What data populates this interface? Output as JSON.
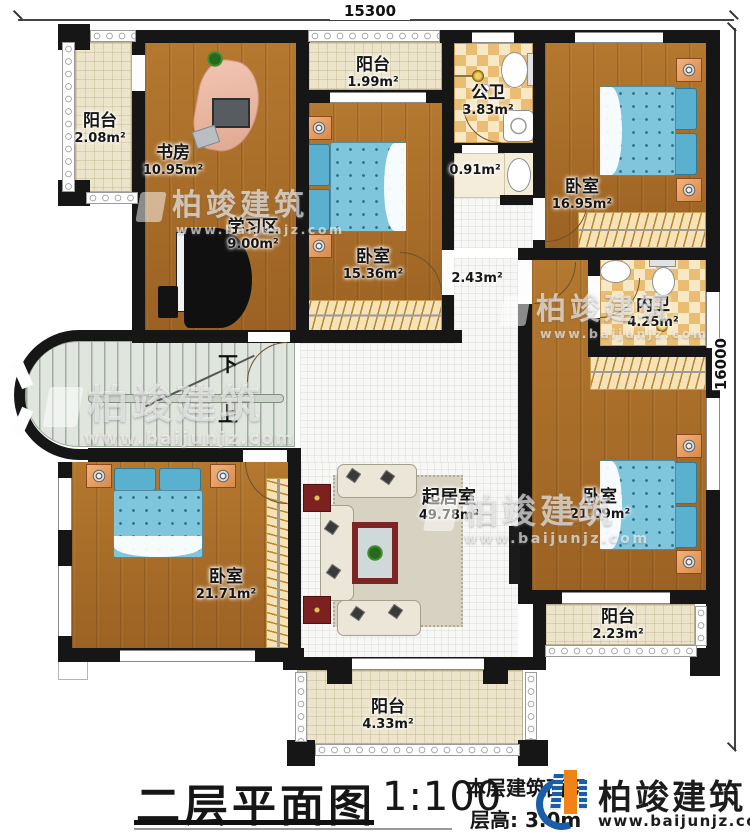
{
  "dimensions": {
    "top": "15300",
    "right": "16000"
  },
  "stairs": {
    "down": "下",
    "up": "上"
  },
  "rooms": {
    "balcony_tl": {
      "name": "阳台",
      "area": "2.08m²"
    },
    "study": {
      "name": "书房",
      "area": "10.95m²"
    },
    "study_area": {
      "name": "学习区",
      "area": "9.00m²"
    },
    "balcony_top": {
      "name": "阳台",
      "area": "1.99m²"
    },
    "bedroom_top": {
      "name": "卧室",
      "area": "15.36m²"
    },
    "public_bath": {
      "name": "公卫",
      "area": "3.83m²"
    },
    "wash_niche": {
      "area": "0.91m²"
    },
    "bedroom_tr": {
      "name": "卧室",
      "area": "16.95m²"
    },
    "corridor": {
      "area": "2.43m²"
    },
    "inner_bath": {
      "name": "内卫",
      "area": "4.25m²"
    },
    "bedroom_r": {
      "name": "卧室",
      "area": "21.09m²"
    },
    "balcony_br": {
      "name": "阳台",
      "area": "2.23m²"
    },
    "living": {
      "name": "起居室",
      "area": "49.78m²"
    },
    "bedroom_bl": {
      "name": "卧室",
      "area": "21.71m²"
    },
    "balcony_bottom": {
      "name": "阳台",
      "area": "4.33m²"
    }
  },
  "title_block": {
    "title": "二层平面图",
    "scale": "1:100",
    "area_note": "本层建筑面积",
    "floor_height": "层高: 3.0m"
  },
  "logo": {
    "name": "柏竣建筑",
    "url": "www.baijunjz.com"
  },
  "watermark": {
    "name": "柏竣建筑",
    "url": "www.baijunjz.com"
  },
  "colors": {
    "wall": "#161616",
    "wood": "#ac7029",
    "bed": "#7fc6dd",
    "logo_blue": "#1b5ea8",
    "logo_orange": "#ef8318"
  }
}
